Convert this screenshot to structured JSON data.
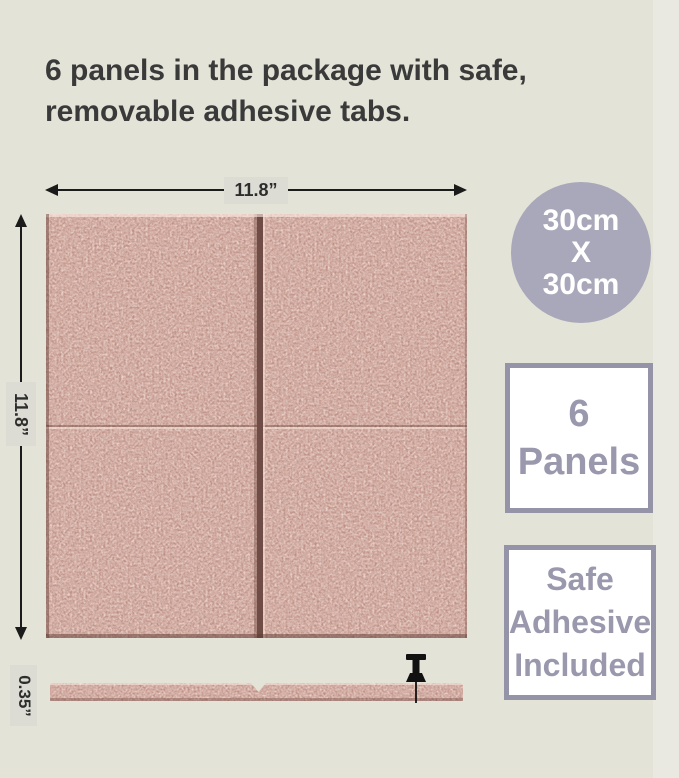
{
  "heading": {
    "line1": "6 panels in the package with safe,",
    "line2": "removable adhesive tabs."
  },
  "diagram": {
    "width_label": "11.8”",
    "height_label": "11.8”",
    "thickness_label": "0.35”"
  },
  "badges": {
    "size_circle": {
      "line1": "30cm",
      "line2": "X",
      "line3": "30cm"
    },
    "panel_count": {
      "line1": "6",
      "line2": "Panels"
    },
    "adhesive": {
      "line1": "Safe",
      "line2": "Adhesive",
      "line3": "Included"
    }
  },
  "icons": {
    "pushpin": "pushpin-icon"
  },
  "colors": {
    "page_background": "#e4e3d7",
    "panel_felt": "#c79b90",
    "panel_gap_shadow": "#6f4c45",
    "size_circle_bg": "#a9a8bb",
    "badge_border": "#9593a8",
    "badge_text": "#9a98ad",
    "heading_text": "#3a3a3a",
    "dimension_label_bg": "#dcdcd4",
    "dimension_line": "#1b1b1b",
    "pushpin": "#111111"
  }
}
